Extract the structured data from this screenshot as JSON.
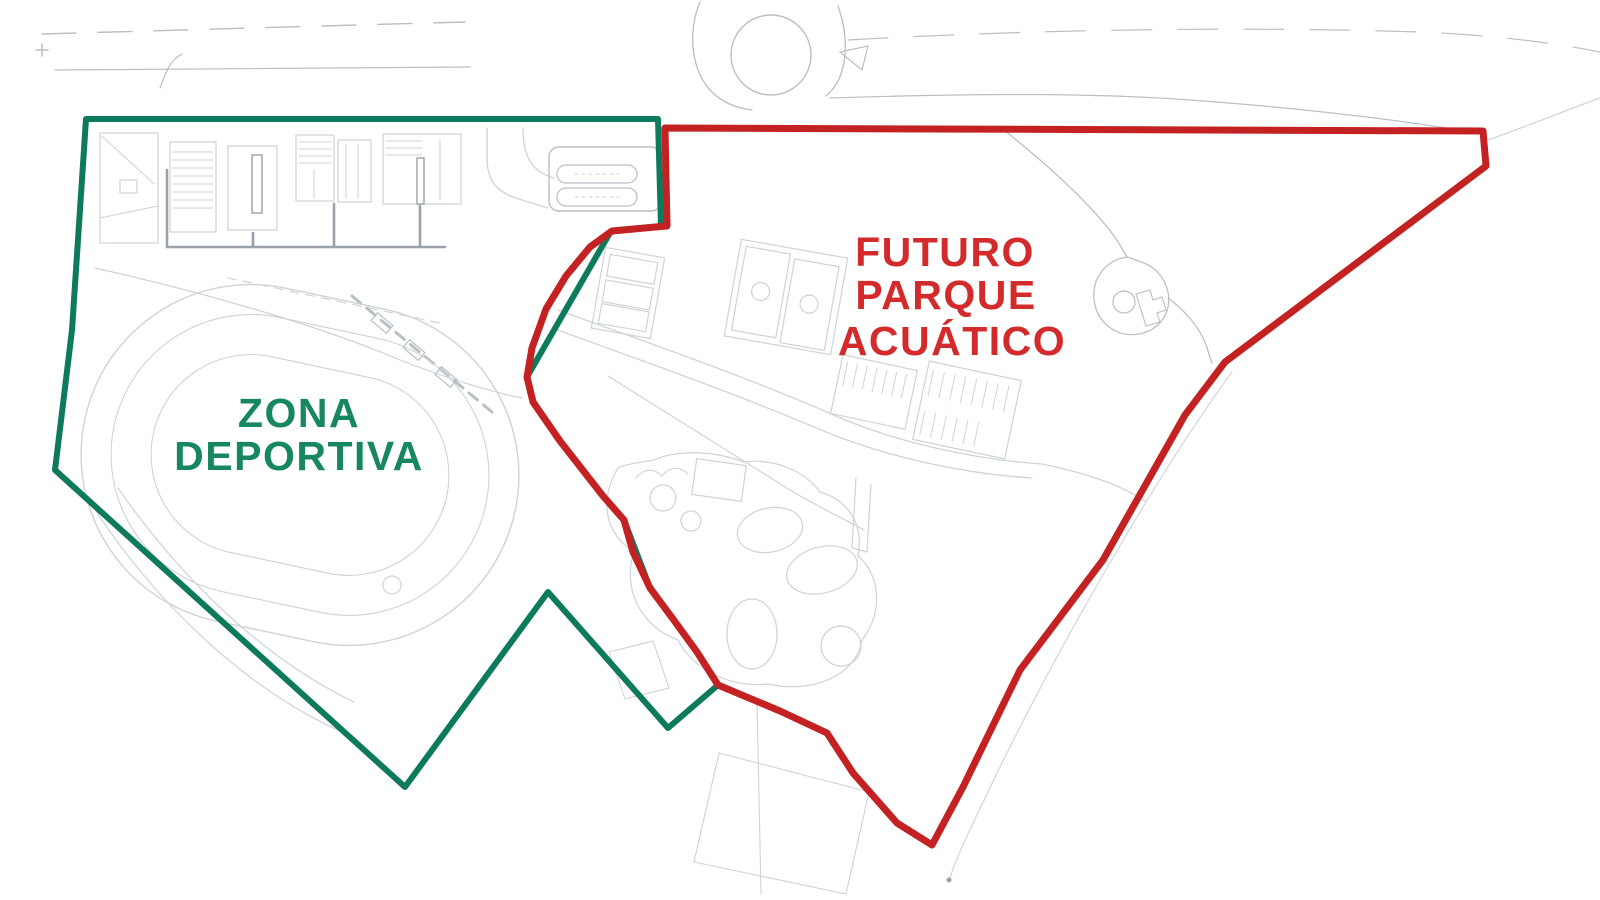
{
  "zones": [
    {
      "name": "zona-deportiva",
      "label_lines": [
        "ZONA",
        "DEPORTIVA"
      ],
      "outline_color": "#0d7a5c",
      "text_color": "#17875f",
      "stroke_width": 6,
      "points": "86,119 658,119 661,226 611,231 527,377 533,402 560,441 603,496 624,520 650,588 673,619 697,652 718,685 668,728 548,592 405,787 55,470 72,330"
    },
    {
      "name": "futuro-parque-acuatico",
      "label_lines": [
        "FUTURO",
        "PARQUE",
        "ACUÁTICO"
      ],
      "outline_color": "#c42222",
      "text_color": "#d32b2b",
      "stroke_width": 7,
      "points": "665,128 1483,131 1486,166 1225,362 1185,415 1103,560 1020,670 963,787 932,845 897,823 853,773 827,733 780,711 718,685 697,652 673,619 650,588 633,552 624,520 603,496 560,441 533,402 527,377 532,348 546,309 566,276 590,247 612,231 667,226"
    }
  ],
  "basemap": {
    "colors": {
      "light": "#ced3d7",
      "mid": "#b9bfc5",
      "dark": "#9aa1a8"
    },
    "paths": [
      {
        "d": "M42,34 L250,28 L465,22",
        "c": "mid",
        "w": 1.4,
        "dash": "34 22",
        "n": "road-edge-top-left"
      },
      {
        "d": "M55,70 L470,67",
        "c": "mid",
        "w": 1.2,
        "n": "road-edge-top-left"
      },
      {
        "d": "M160,88 C166,72 170,60 182,54",
        "c": "mid",
        "w": 1.2,
        "n": "road-detail"
      },
      {
        "d": "M700,2 C688,30 690,70 712,92 C722,102 736,108 752,110",
        "c": "mid",
        "w": 1.3,
        "n": "roundabout-approach-left"
      },
      {
        "d": "M838,6 C850,40 848,78 826,96",
        "c": "mid",
        "w": 1.3,
        "n": "roundabout-approach-right"
      },
      {
        "d": "M840,52 L868,46 L862,70 Z",
        "c": "mid",
        "w": 1.2,
        "n": "traffic-island"
      },
      {
        "d": "M848,40 C1020,30 1240,26 1420,32 C1490,35 1550,42 1600,52",
        "c": "mid",
        "w": 1.2,
        "dash": "40 26",
        "n": "road-edge-top-right"
      },
      {
        "d": "M830,98 C960,94 1080,92 1190,100 C1300,108 1400,120 1478,133",
        "c": "mid",
        "w": 1.2,
        "n": "road-edge-right"
      },
      {
        "d": "M1488,140 C1522,128 1562,112 1600,98",
        "c": "light",
        "w": 1.2,
        "n": "road-edge-corner"
      },
      {
        "d": "M42,44 v12 M36,50 h12",
        "c": "mid",
        "w": 1.5,
        "n": "survey-mark"
      },
      {
        "d": "M102,136 L154,184",
        "c": "light",
        "w": 1.1,
        "n": "building-detail"
      },
      {
        "d": "M100,218 L158,206 M106,243 L152,243",
        "c": "light",
        "w": 1.1,
        "n": "building-detail"
      },
      {
        "d": "M173,152 h40 M173,160 h40 M173,168 h40 M173,176 h40 M173,184 h40 M173,192 h40 M173,200 h40 M173,208 h40",
        "c": "light",
        "w": 1,
        "n": "building-stairs"
      },
      {
        "d": "M299,142 h32 M299,149 h32 M299,156 h32 M299,163 h32 M314,170 v28",
        "c": "light",
        "w": 1,
        "n": "building-detail"
      },
      {
        "d": "M346,144 v54 M358,144 v54",
        "c": "light",
        "w": 1,
        "n": "building-detail"
      },
      {
        "d": "M386,141 h36 M386,148 h36 M386,155 h36 M440,140 v60",
        "c": "light",
        "w": 1,
        "n": "building-detail"
      },
      {
        "d": "M167,170 L167,247 L445,247 M334,204 L334,247 M420,206 L420,247 M253,233 L253,247",
        "c": "dark",
        "w": 2.6,
        "n": "corridor"
      },
      {
        "d": "M487,128 L487,158 C487,184 500,194 522,200 L548,208",
        "c": "light",
        "w": 1.3,
        "n": "access-road"
      },
      {
        "d": "M523,128 C523,160 534,172 554,178",
        "c": "light",
        "w": 1.3,
        "n": "access-road"
      },
      {
        "d": "M95,268 C220,296 330,330 400,360 C452,380 492,392 522,398",
        "c": "light",
        "w": 1.2,
        "n": "path"
      },
      {
        "d": "M566,165 h62 a9,9 0 0 1 0,18 h-62 a9,9 0 0 1 0,-18 Z",
        "c": "mid",
        "w": 1.2,
        "n": "parking-row"
      },
      {
        "d": "M566,188 h62 a9,9 0 0 1 0,18 h-62 a9,9 0 0 1 0,-18 Z",
        "c": "mid",
        "w": 1.2,
        "n": "parking-row"
      },
      {
        "d": "M575,174 h44 M575,197 h44",
        "c": "light",
        "w": 1,
        "dash": "3 4",
        "n": "parking-stalls"
      },
      {
        "d": "M190,297 L412,297",
        "c": "light",
        "w": 1.2,
        "dash": "9 7",
        "t": "rotate(12 300 465)",
        "n": "track-lane"
      },
      {
        "d": "M352,296 L492,412",
        "c": "mid",
        "w": 3,
        "dash": "11 8",
        "n": "grandstand-steps"
      },
      {
        "d": "M92,505 C160,610 252,692 342,732",
        "c": "light",
        "w": 1.2,
        "n": "path"
      },
      {
        "d": "M118,488 C186,586 270,662 354,702",
        "c": "light",
        "w": 1.2,
        "n": "path"
      },
      {
        "d": "M558,310 C640,340 740,374 836,416 C900,444 980,460 1042,464",
        "c": "light",
        "w": 1.3,
        "n": "park-road"
      },
      {
        "d": "M552,328 C640,360 732,392 826,432 C890,458 966,474 1032,478",
        "c": "light",
        "w": 1.3,
        "n": "park-road"
      },
      {
        "d": "M608,376 C662,410 726,450 790,490 C820,508 850,522 864,530",
        "c": "light",
        "w": 1.2,
        "n": "park-road"
      },
      {
        "d": "M1042,464 C1090,474 1124,486 1146,502",
        "c": "light",
        "w": 1.2,
        "n": "park-road"
      },
      {
        "d": "M618,468 C598,502 606,534 634,552 C622,588 640,626 678,640 C692,668 728,688 768,684 C812,694 856,676 862,640 C884,612 880,574 858,556 C864,524 848,500 820,492 C804,470 772,458 744,462 C712,450 676,450 654,460 C636,463 626,464 618,468 Z",
        "c": "light",
        "w": 1.2,
        "n": "waterpark-area-outline"
      },
      {
        "d": "M636,478 c8,-10 18,-10 26,-2 c8,-10 18,-10 26,-2",
        "c": "light",
        "w": 1.1,
        "n": "slide-detail"
      },
      {
        "d": "M856,478 L852,548 M871,484 L867,552 M852,548 L867,552",
        "c": "light",
        "w": 1.2,
        "n": "plan-detail"
      },
      {
        "d": "M1004,130 C1044,162 1082,196 1108,228 C1116,238 1122,248 1127,257",
        "c": "mid",
        "w": 1.3,
        "n": "path-right"
      },
      {
        "d": "M1127,257 C1106,260 1092,278 1094,299 C1096,322 1116,338 1139,334 C1160,330 1172,312 1168,292 C1165,278 1155,266 1141,262 C1136,260 1131,258 1127,257 Z",
        "c": "mid",
        "w": 1.3,
        "n": "cul-de-sac"
      },
      {
        "d": "M1136,294 l14,-4 l3,10 l9,-3 l4,13 l-9,3 l3,9 l-14,4 Z",
        "c": "mid",
        "w": 1.1,
        "n": "plan-detail"
      },
      {
        "d": "M1168,298 C1184,310 1196,324 1203,338 C1208,348 1209,356 1212,363",
        "c": "mid",
        "w": 1.3,
        "n": "path-right"
      },
      {
        "d": "M1232,372 C1160,470 1062,640 996,775 C976,818 958,852 950,878",
        "c": "light",
        "w": 1.1,
        "n": "trail"
      },
      {
        "d": "M719,753 L694,862 L846,894 L869,792 Z",
        "c": "light",
        "w": 1.1,
        "n": "parcel-outline"
      },
      {
        "d": "M757,700 L761,894",
        "c": "light",
        "w": 1.1,
        "n": "parcel-line"
      },
      {
        "d": "M609,652 L653,641 L669,688 L625,699 Z",
        "c": "light",
        "w": 1.1,
        "n": "building-outline"
      },
      {
        "d": "M842,368 v24 M852,368 v24 M862,368 v24 M872,368 v24 M882,368 v24 M892,368 v24 M902,368 v24",
        "c": "light",
        "w": 1,
        "t": "rotate(12 874 392)",
        "n": "building-stripes"
      },
      {
        "d": "M926,378 v26 M937,378 v26 M948,378 v26 M959,378 v26 M970,378 v26 M981,378 v26 M992,378 v26 M1003,378 v26",
        "c": "light",
        "w": 1,
        "t": "rotate(12 967 410)",
        "n": "building-stripes"
      },
      {
        "d": "M926,420 v24 M937,420 v24 M948,420 v24 M959,420 v24 M970,420 v24 M981,420 v24",
        "c": "light",
        "w": 1,
        "t": "rotate(12 967 410)",
        "n": "building-stripes"
      }
    ],
    "rects": [
      {
        "x": 100,
        "y": 133,
        "w": 58,
        "h": 110,
        "n": "building"
      },
      {
        "x": 170,
        "y": 142,
        "w": 46,
        "h": 90,
        "n": "building"
      },
      {
        "x": 228,
        "y": 146,
        "w": 49,
        "h": 84,
        "n": "building"
      },
      {
        "x": 252,
        "y": 155,
        "w": 10,
        "h": 58,
        "c": "dark",
        "w2": 1.4,
        "n": "building-core"
      },
      {
        "x": 296,
        "y": 135,
        "w": 38,
        "h": 66,
        "n": "building"
      },
      {
        "x": 338,
        "y": 140,
        "w": 33,
        "h": 62,
        "n": "building"
      },
      {
        "x": 383,
        "y": 134,
        "w": 78,
        "h": 70,
        "n": "building"
      },
      {
        "x": 417,
        "y": 158,
        "w": 7,
        "h": 46,
        "c": "dark",
        "w2": 1.4,
        "n": "building-core"
      },
      {
        "x": 549,
        "y": 147,
        "w": 112,
        "h": 64,
        "rx": 10,
        "c": "mid",
        "w2": 1.4,
        "n": "parking-lot"
      },
      {
        "x": 80,
        "y": 295,
        "w": 440,
        "h": 340,
        "rx": 170,
        "t": "rotate(12 300 465)",
        "w2": 1.4,
        "n": "running-track-outer"
      },
      {
        "x": 110,
        "y": 325,
        "w": 380,
        "h": 280,
        "rx": 140,
        "t": "rotate(12 300 465)",
        "w2": 1.1,
        "n": "running-track-lane"
      },
      {
        "x": 150,
        "y": 365,
        "w": 300,
        "h": 200,
        "rx": 100,
        "t": "rotate(12 300 465)",
        "w2": 1.1,
        "n": "running-track-infield"
      },
      {
        "x": 598,
        "y": 252,
        "w": 60,
        "h": 82,
        "t": "rotate(10 628 293)",
        "n": "court-block"
      },
      {
        "x": 604,
        "y": 258,
        "w": 48,
        "h": 22,
        "t": "rotate(10 628 293)",
        "n": "court"
      },
      {
        "x": 604,
        "y": 284,
        "w": 48,
        "h": 22,
        "t": "rotate(10 628 293)",
        "n": "court"
      },
      {
        "x": 604,
        "y": 308,
        "w": 48,
        "h": 20,
        "t": "rotate(10 628 293)",
        "n": "court"
      },
      {
        "x": 732,
        "y": 248,
        "w": 108,
        "h": 98,
        "t": "rotate(10 786 297)",
        "n": "basketball-block"
      },
      {
        "x": 738,
        "y": 254,
        "w": 45,
        "h": 85,
        "t": "rotate(10 786 297)",
        "n": "basketball-court"
      },
      {
        "x": 788,
        "y": 258,
        "w": 45,
        "h": 85,
        "t": "rotate(10 786 297)",
        "n": "basketball-court"
      },
      {
        "x": 836,
        "y": 362,
        "w": 76,
        "h": 60,
        "t": "rotate(12 874 392)",
        "n": "building"
      },
      {
        "x": 920,
        "y": 370,
        "w": 94,
        "h": 80,
        "t": "rotate(12 967 410)",
        "n": "building"
      },
      {
        "x": 694,
        "y": 462,
        "w": 50,
        "h": 36,
        "t": "rotate(8 719 480)",
        "n": "building"
      },
      {
        "x": 372,
        "y": 318,
        "w": 20,
        "h": 10,
        "t": "rotate(40 382 323)",
        "c": "mid",
        "n": "bleacher"
      },
      {
        "x": 404,
        "y": 345,
        "w": 20,
        "h": 10,
        "t": "rotate(40 414 350)",
        "c": "mid",
        "n": "bleacher"
      },
      {
        "x": 436,
        "y": 372,
        "w": 20,
        "h": 10,
        "t": "rotate(40 446 377)",
        "c": "mid",
        "n": "bleacher"
      },
      {
        "x": 120,
        "y": 180,
        "w": 17,
        "h": 13,
        "n": "building-detail"
      }
    ],
    "circles": [
      {
        "cx": 771,
        "cy": 55,
        "r": 40,
        "c": "mid",
        "w": 1.4,
        "n": "roundabout"
      },
      {
        "cx": 392,
        "cy": 585,
        "r": 9,
        "n": "plan-circle"
      },
      {
        "cx": 663,
        "cy": 498,
        "r": 13,
        "n": "pool"
      },
      {
        "cx": 691,
        "cy": 521,
        "r": 10,
        "n": "pool"
      },
      {
        "cx": 841,
        "cy": 646,
        "r": 20,
        "n": "pool"
      },
      {
        "cx": 760,
        "cy": 296,
        "r": 9,
        "t": "rotate(10 786 297)",
        "n": "court-circle"
      },
      {
        "cx": 810,
        "cy": 300,
        "r": 9,
        "t": "rotate(10 786 297)",
        "n": "court-circle"
      },
      {
        "cx": 1124,
        "cy": 302,
        "r": 11,
        "c": "mid",
        "n": "cul-de-sac-island"
      },
      {
        "cx": 949,
        "cy": 880,
        "r": 2.5,
        "c": "dark",
        "f": true,
        "n": "plan-dot"
      }
    ],
    "ellipses": [
      {
        "cx": 770,
        "cy": 530,
        "rx": 33,
        "ry": 22,
        "t": "rotate(-12 770 530)",
        "n": "pool"
      },
      {
        "cx": 822,
        "cy": 570,
        "rx": 36,
        "ry": 23,
        "t": "rotate(-15 822 570)",
        "n": "pool"
      },
      {
        "cx": 752,
        "cy": 634,
        "rx": 25,
        "ry": 35,
        "n": "pool"
      }
    ]
  }
}
